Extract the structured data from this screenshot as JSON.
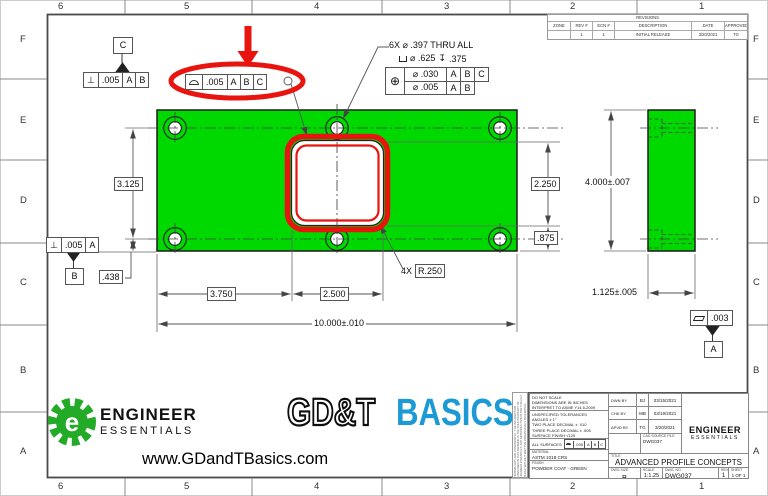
{
  "sheet": {
    "zones_top": [
      "6",
      "5",
      "4",
      "3",
      "2",
      "1"
    ],
    "zones_bottom": [
      "6",
      "5",
      "4",
      "3",
      "2",
      "1"
    ],
    "zones_left": [
      "F",
      "E",
      "D",
      "C",
      "B",
      "A"
    ],
    "zones_right": [
      "F",
      "E",
      "D",
      "C",
      "B",
      "A"
    ]
  },
  "revisions": {
    "title": "REVISIONS",
    "headers": {
      "zone": "ZONE",
      "rev": "REV #",
      "ecn": "ECN #",
      "description": "DESCRIPTION",
      "date": "DATE",
      "approved": "APPROVED"
    },
    "row": {
      "zone": "",
      "rev": "1",
      "ecn": "1",
      "description": "INITIAL RELEASE",
      "date": "3/20/2021",
      "approved": "TG"
    }
  },
  "hole_callout": {
    "line1": "6X ⌀ .397 THRU ALL",
    "cbore_dia": "⌀ .625",
    "depth_symbol": "↧",
    "cbore_depth": ".375",
    "position_symbol": "⊕",
    "row1": {
      "tol": "⌀ .030",
      "d1": "A",
      "d2": "B",
      "d3": "C"
    },
    "row2": {
      "tol": "⌀ .005",
      "d1": "A",
      "d2": "B"
    }
  },
  "fcf": {
    "perp_symbol": "⊥",
    "perp_top": {
      "tol": ".005",
      "d1": "A",
      "d2": "B"
    },
    "profile": {
      "tol": ".005",
      "d1": "A",
      "d2": "B",
      "d3": "C"
    },
    "perp_bottom": {
      "tol": ".005",
      "d1": "A"
    },
    "flatness_tol": ".003",
    "all_surfaces_label": "ALL SURFACES",
    "all_surfaces": {
      "tol": ".030",
      "d1": "A",
      "d2": "B",
      "d3": "C"
    }
  },
  "datums": {
    "a": "A",
    "b": "B",
    "c": "C"
  },
  "dims": {
    "row_spacing": "3.125",
    "edge_to_hole": ".438",
    "left_to_cutout": "3.750",
    "cutout_width": "2.500",
    "overall_width": "10.000±.010",
    "cutout_height": "2.250",
    "cutout_to_edge": ".875",
    "overall_height": "4.000±.007",
    "thickness": "1.125±.005",
    "corner_qty": "4X",
    "corner_radius": "R.250"
  },
  "titleblock": {
    "notes": [
      "DO NOT SCALE",
      "DIMENSIONS ARE IN INCHES",
      "INTERPRET TO ASME Y14.5-2009"
    ],
    "tolerances": [
      "UNSPECIFIED TOLERANCES",
      "ANGLES ± 1°",
      "TWO PLACE DECIMAL  ± .010",
      "THREE PLACE DECIMAL  ± .005",
      "SURFACE FINISH  √125"
    ],
    "material_label": "MATERIAL",
    "material": "ASTM 1018 CRS",
    "finish_label": "FINISH",
    "finish": "POWDER COAT - GREEN",
    "drawn": {
      "label": "DWN BY",
      "initials": "BJ",
      "date": "03/15/2021"
    },
    "checked": {
      "label": "CHK BY",
      "initials": "MB",
      "date": "03/19/2021"
    },
    "approved": {
      "label": "APVD BY",
      "initials": "TG",
      "date": "3/20/2021"
    },
    "cad_label": "CAD SOURCE FILE",
    "cad_file": "DWG037",
    "title_label": "TITLE",
    "title": "ADVANCED PROFILE CONCEPTS",
    "size_label": "DWG SIZE",
    "size": "B",
    "scale_label": "SCALE",
    "scale": "1:1.25",
    "dwgno_label": "DWG. NO.",
    "dwgno": "DWG037",
    "rev_label": "REV",
    "rev": "1",
    "sheet_label": "SHEET",
    "sheet": "1 OF 1",
    "fine_print": "PROPRIETARY AND CONFIDENTIAL: THE INFORMATION CONTAINED IN THIS DRAWING IS THE SOLE PROPERTY OF ENGINEER ESSENTIALS. ANY REPRODUCTION IN PART OR AS A WHOLE WITHOUT WRITTEN PERMISSION IS PROHIBITED."
  },
  "branding": {
    "engineer": "ENGINEER",
    "essentials": "ESSENTIALS",
    "gdt": "GD&T",
    "basics": "BASICS",
    "url": "www.GDandTBasics.com",
    "logo_letter": "e"
  },
  "colors": {
    "part_green": "#00d900",
    "highlight_red": "#e8140f",
    "brand_green": "#23aa27",
    "brand_blue": "#1b9ad6"
  }
}
